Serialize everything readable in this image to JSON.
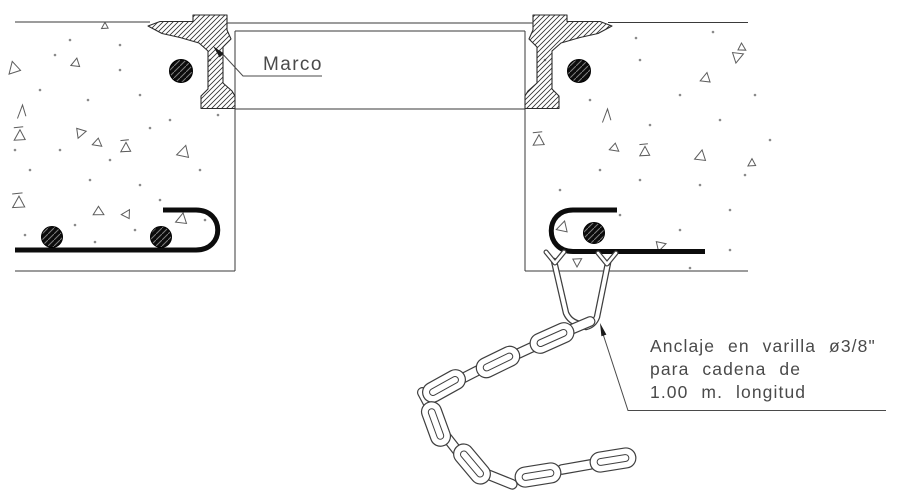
{
  "drawing": {
    "labels": {
      "frame_label": "Marco"
    },
    "note": {
      "line1": "Anclaje en varilla ø3/8\"",
      "line2": "para cadena de",
      "line3": "1.00 m. longitud"
    },
    "colors": {
      "line": "#3a3a3a",
      "text": "#4a4a4a",
      "steel": "#0c0c0c",
      "texture": "#5c5c5c",
      "background": "#ffffff"
    },
    "rebar_sections": [
      {
        "x": 181,
        "y": 71,
        "r": 11.5
      },
      {
        "x": 579,
        "y": 71,
        "r": 11.5
      },
      {
        "x": 52,
        "y": 237,
        "r": 10.5
      },
      {
        "x": 161,
        "y": 237,
        "r": 10.5
      },
      {
        "x": 594,
        "y": 233,
        "r": 10.5
      }
    ],
    "chain": {
      "links": [
        {
          "x": 577,
          "y": 327,
          "a": -23,
          "t": "edge"
        },
        {
          "x": 552,
          "y": 338,
          "a": -24,
          "t": "face"
        },
        {
          "x": 526,
          "y": 350,
          "a": -25,
          "t": "edge"
        },
        {
          "x": 498,
          "y": 362,
          "a": -26,
          "t": "face"
        },
        {
          "x": 471,
          "y": 374,
          "a": -27,
          "t": "edge"
        },
        {
          "x": 444,
          "y": 386,
          "a": -29,
          "t": "face"
        },
        {
          "x": 429,
          "y": 405,
          "a": 62,
          "t": "edge"
        },
        {
          "x": 436,
          "y": 424,
          "a": 70,
          "t": "face"
        },
        {
          "x": 452,
          "y": 444,
          "a": 52,
          "t": "edge"
        },
        {
          "x": 472,
          "y": 464,
          "a": 50,
          "t": "face"
        },
        {
          "x": 499,
          "y": 479,
          "a": 22,
          "t": "edge"
        },
        {
          "x": 538,
          "y": 475,
          "a": -9,
          "t": "face"
        },
        {
          "x": 576,
          "y": 467,
          "a": -10,
          "t": "edge"
        },
        {
          "x": 613,
          "y": 460,
          "a": -9,
          "t": "face"
        }
      ]
    },
    "aggregate": {
      "marks": [
        {
          "t": "tri",
          "x": 14,
          "y": 68,
          "s": 11,
          "r": -15
        },
        {
          "t": "tri",
          "x": 76,
          "y": 63,
          "s": 8,
          "r": 10
        },
        {
          "t": "tri",
          "x": 105,
          "y": 26,
          "s": 6,
          "r": 0
        },
        {
          "t": "angle",
          "x": 22,
          "y": 112,
          "s": 13,
          "r": 0
        },
        {
          "t": "tribar",
          "x": 20,
          "y": 136,
          "s": 10,
          "r": 0
        },
        {
          "t": "tri",
          "x": 80,
          "y": 133,
          "s": 9,
          "r": 200
        },
        {
          "t": "tri",
          "x": 97,
          "y": 143,
          "s": 8,
          "r": 250
        },
        {
          "t": "tribar",
          "x": 126,
          "y": 148,
          "s": 9,
          "r": 0
        },
        {
          "t": "tri",
          "x": 184,
          "y": 152,
          "s": 11,
          "r": 15
        },
        {
          "t": "tribar",
          "x": 19,
          "y": 203,
          "s": 11,
          "r": 0
        },
        {
          "t": "tri",
          "x": 98,
          "y": 212,
          "s": 9,
          "r": 240
        },
        {
          "t": "tri",
          "x": 127,
          "y": 214,
          "s": 8,
          "r": 30
        },
        {
          "t": "tri",
          "x": 182,
          "y": 219,
          "s": 10,
          "r": 10
        },
        {
          "t": "tri",
          "x": 737,
          "y": 57,
          "s": 10,
          "r": 190
        },
        {
          "t": "tri",
          "x": 706,
          "y": 78,
          "s": 9,
          "r": 10
        },
        {
          "t": "tri",
          "x": 742,
          "y": 48,
          "s": 7,
          "r": 120
        },
        {
          "t": "angle",
          "x": 607,
          "y": 116,
          "s": 13,
          "r": 0
        },
        {
          "t": "tribar",
          "x": 539,
          "y": 141,
          "s": 10,
          "r": 0
        },
        {
          "t": "tri",
          "x": 614,
          "y": 148,
          "s": 8,
          "r": 250
        },
        {
          "t": "tribar",
          "x": 645,
          "y": 152,
          "s": 9,
          "r": 0
        },
        {
          "t": "tri",
          "x": 701,
          "y": 156,
          "s": 10,
          "r": 10
        },
        {
          "t": "tri",
          "x": 752,
          "y": 163,
          "s": 7,
          "r": 0
        },
        {
          "t": "tri",
          "x": 563,
          "y": 227,
          "s": 10,
          "r": 15
        },
        {
          "t": "tri",
          "x": 577,
          "y": 262,
          "s": 8,
          "r": 180
        },
        {
          "t": "tri",
          "x": 660,
          "y": 246,
          "s": 9,
          "r": 195
        }
      ],
      "dots": [
        [
          70,
          40
        ],
        [
          120,
          45
        ],
        [
          55,
          55
        ],
        [
          210,
          60
        ],
        [
          120,
          70
        ],
        [
          40,
          90
        ],
        [
          88,
          100
        ],
        [
          140,
          95
        ],
        [
          15,
          150
        ],
        [
          60,
          150
        ],
        [
          110,
          160
        ],
        [
          150,
          128
        ],
        [
          170,
          120
        ],
        [
          30,
          170
        ],
        [
          90,
          180
        ],
        [
          140,
          185
        ],
        [
          200,
          170
        ],
        [
          218,
          115
        ],
        [
          160,
          200
        ],
        [
          25,
          235
        ],
        [
          75,
          225
        ],
        [
          135,
          230
        ],
        [
          170,
          240
        ],
        [
          205,
          220
        ],
        [
          95,
          242
        ],
        [
          545,
          60
        ],
        [
          636,
          38
        ],
        [
          713,
          32
        ],
        [
          590,
          100
        ],
        [
          640,
          60
        ],
        [
          680,
          95
        ],
        [
          720,
          120
        ],
        [
          755,
          95
        ],
        [
          650,
          125
        ],
        [
          770,
          140
        ],
        [
          600,
          170
        ],
        [
          640,
          180
        ],
        [
          700,
          185
        ],
        [
          745,
          175
        ],
        [
          560,
          190
        ],
        [
          620,
          215
        ],
        [
          680,
          230
        ],
        [
          730,
          210
        ],
        [
          690,
          268
        ],
        [
          730,
          250
        ]
      ]
    }
  }
}
